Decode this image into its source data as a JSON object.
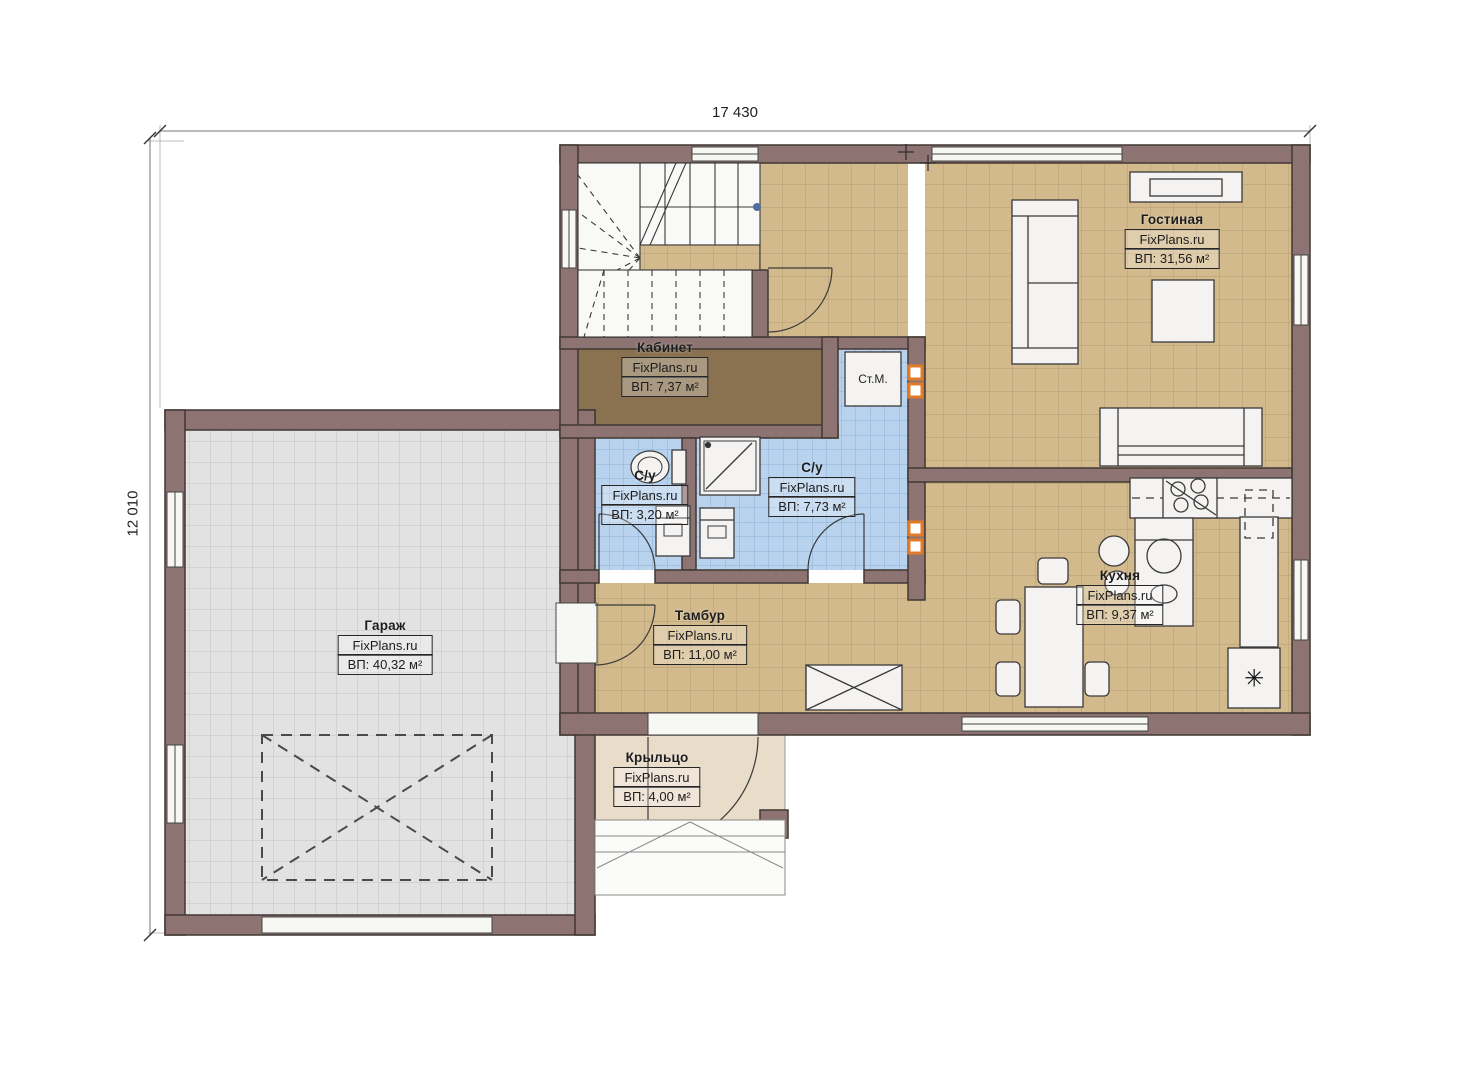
{
  "drawing": {
    "type": "floor-plan",
    "dimensions": {
      "top": "17 430",
      "left": "12 010"
    },
    "watermark": "FixPlans.ru"
  },
  "rooms": [
    {
      "name": "Гостиная",
      "brand": "FixPlans.ru",
      "area": "ВП: 31,56 м²"
    },
    {
      "name": "Кабинет",
      "brand": "FixPlans.ru",
      "area": "ВП: 7,37 м²"
    },
    {
      "name": "С/у",
      "brand": "FixPlans.ru",
      "area": "ВП: 3,20 м²"
    },
    {
      "name": "С/у",
      "brand": "FixPlans.ru",
      "area": "ВП: 7,73 м²"
    },
    {
      "name": "Тамбур",
      "brand": "FixPlans.ru",
      "area": "ВП: 11,00 м²"
    },
    {
      "name": "Гараж",
      "brand": "FixPlans.ru",
      "area": "ВП: 40,32 м²"
    },
    {
      "name": "Кухня",
      "brand": "FixPlans.ru",
      "area": "ВП: 9,37 м²"
    },
    {
      "name": "Крыльцо",
      "brand": "FixPlans.ru",
      "area": "ВП: 4,00 м²"
    }
  ],
  "appliances": {
    "washing_machine": "Ст.М.",
    "fridge_symbol": "✳"
  },
  "colors": {
    "wall": "#8d7472",
    "wall_stroke": "#413733",
    "floor_tan": "#d3ba8d",
    "floor_blue": "#b9d3ee",
    "floor_gray": "#e1e1e1",
    "floor_office": "#8a7251",
    "floor_porch": "#e9dcc9",
    "vent_accent": "#e07b2a"
  }
}
